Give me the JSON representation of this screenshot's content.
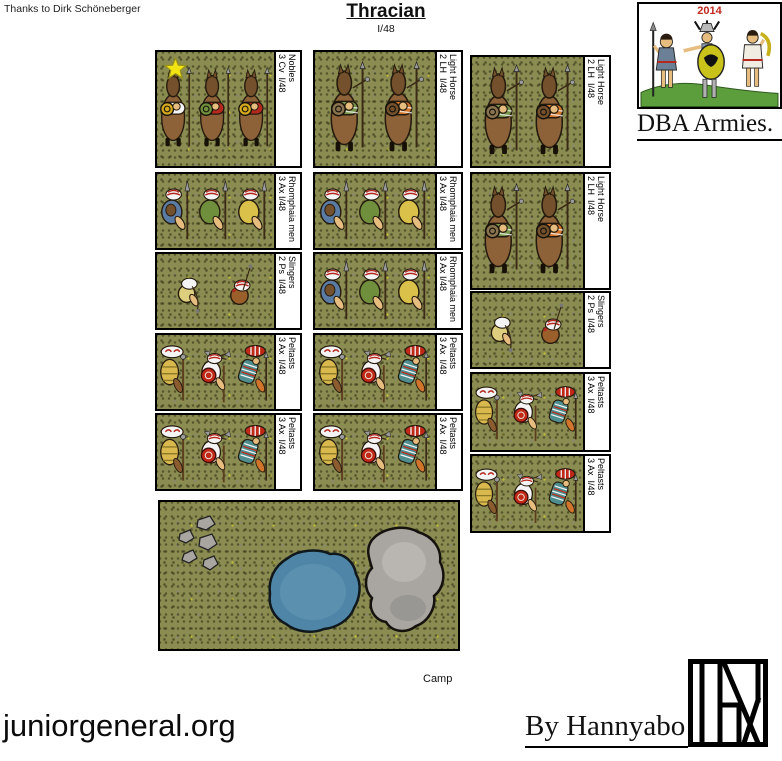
{
  "header": {
    "thanks": "Thanks to Dirk Schöneberger",
    "title": "Thracian",
    "subtitle": "I/48"
  },
  "logo_box": {
    "year": "2014",
    "caption": "DBA Armies."
  },
  "army": {
    "columns": [
      {
        "units": [
          {
            "code": "3 Cv  I/48",
            "name": "Nobles",
            "type": "cavalry",
            "star": true,
            "figure_count": 3
          },
          {
            "code": "3 Ax I/48",
            "name": "Rhomphaia men",
            "type": "rhomphaia",
            "figure_count": 3
          },
          {
            "code": "2 Ps  I/48",
            "name": "Slingers",
            "type": "slingers",
            "figure_count": 2
          },
          {
            "code": "3 Ax  I/48",
            "name": "Peltasts",
            "type": "peltasts",
            "figure_count": 3
          },
          {
            "code": "3 Ax  I/48",
            "name": "Peltasts",
            "type": "peltasts",
            "figure_count": 3
          }
        ]
      },
      {
        "units": [
          {
            "code": "2 LH  I/48",
            "name": "Light Horse",
            "type": "lighthorse",
            "figure_count": 2
          },
          {
            "code": "3 Ax I/48",
            "name": "Rhomphaia men",
            "type": "rhomphaia",
            "figure_count": 3
          },
          {
            "code": "3 Ax I/48",
            "name": "Rhomphaia men",
            "type": "rhomphaia",
            "figure_count": 3
          },
          {
            "code": "3 Ax  I/48",
            "name": "Peltasts",
            "type": "peltasts",
            "figure_count": 3
          },
          {
            "code": "3 Ax  I/48",
            "name": "Peltasts",
            "type": "peltasts",
            "figure_count": 3
          }
        ]
      },
      {
        "units": [
          {
            "code": "2 LH  I/48",
            "name": "Light Horse",
            "type": "lighthorse",
            "figure_count": 2
          },
          {
            "code": "2 LH  I/48",
            "name": "Light Horse",
            "type": "lighthorse",
            "figure_count": 2
          },
          {
            "code": "2 Ps  I/48",
            "name": "Slingers",
            "type": "slingers",
            "figure_count": 2
          },
          {
            "code": "3 Ax  I/48",
            "name": "Peltasts",
            "type": "peltasts",
            "figure_count": 3
          },
          {
            "code": "3 Ax  I/48",
            "name": "Peltasts",
            "type": "peltasts",
            "figure_count": 3
          }
        ]
      }
    ],
    "camp": {
      "label": "Camp"
    }
  },
  "footer": {
    "site": "juniorgeneral.org",
    "credit": "By Hannyabo"
  },
  "palette": {
    "grass": "#8b8c51",
    "outline": "#241a0d",
    "horse": "#8d6239",
    "horse_dark": "#74512c",
    "flesh": "#e6bd7f",
    "white": "#f4f4f4",
    "red": "#b5281e",
    "blue": "#5a7ba3",
    "green": "#6f8f3c",
    "yellow": "#d9c14a",
    "gold": "#d4a81f",
    "orange": "#d0752b",
    "teal": "#4f8e8e",
    "steel": "#9b9b9b",
    "shield_brown": "#8a7450",
    "pond": "#4f86a7",
    "pond_light": "#74a7bf",
    "rock": "#a9a6a2",
    "rock_light": "#c6c3c0",
    "rock_dark": "#8a8784",
    "star": "#f2e313",
    "star_edge": "#97931d",
    "year_red": "#c0281e",
    "label_bg": "#ffffff"
  }
}
